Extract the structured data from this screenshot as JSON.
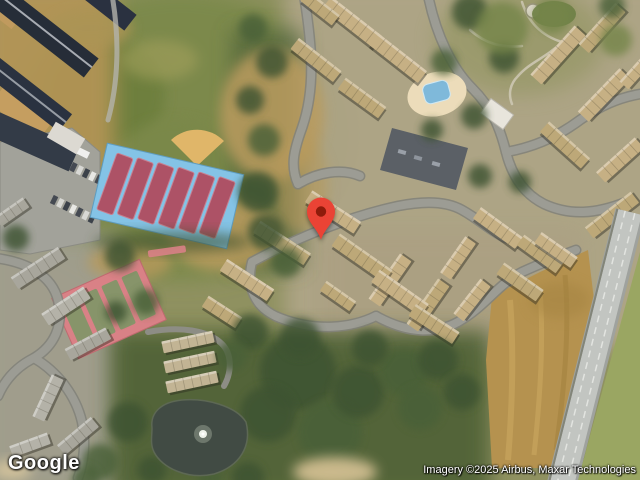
{
  "branding": {
    "logo_text": "Google"
  },
  "attribution": {
    "text": "Imagery ©2025 Airbus, Maxar Technologies"
  },
  "marker": {
    "label": "map-pin",
    "color": "#EA4335",
    "dot_color": "#8E1B0B",
    "x": 321,
    "y": 240
  }
}
